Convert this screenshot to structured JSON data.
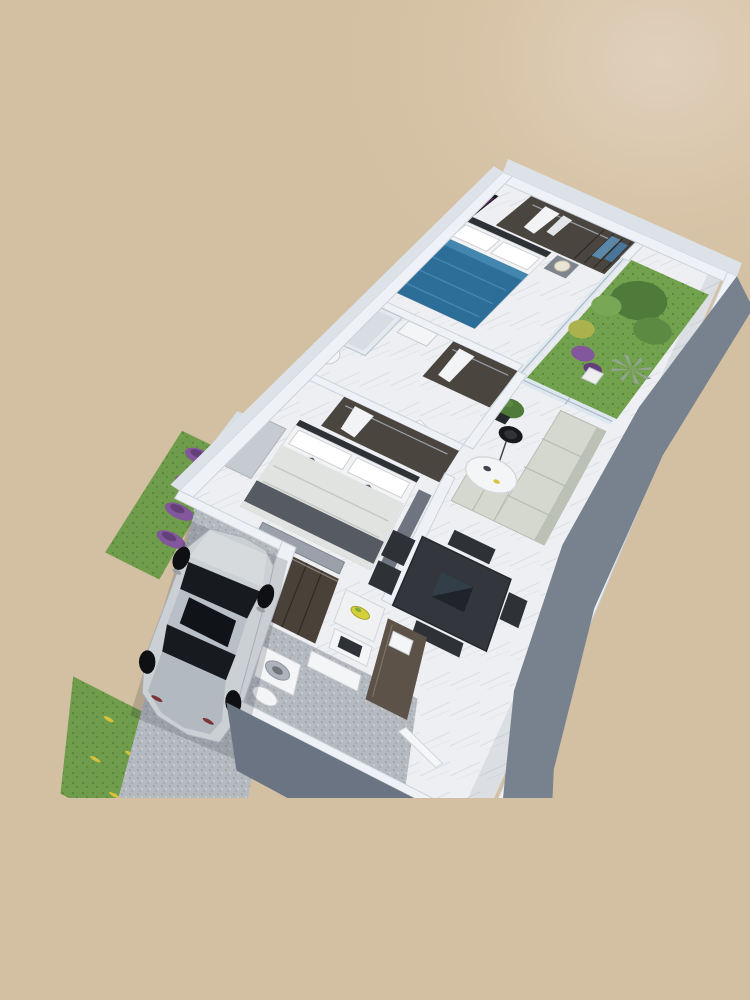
{
  "image": {
    "kind": "3d-floor-plan-render",
    "view": "isometric dollhouse top view, strip rotated toward lower-left, photo cropped flat at bottom",
    "background_color": "#d3bfa1",
    "background_highlight": "#e0d0bc",
    "crop_bottom_y": 798
  },
  "palette": {
    "bg": "#d3bfa1",
    "wall_cap": "#eef1f5",
    "wall_cap_stroke": "#ccd2da",
    "wall_face_dark": "#78828f",
    "wall_face_darker": "#6a7482",
    "wall_face_light": "#dde2e9",
    "floor_marble": "#edeff2",
    "floor_vein": "#c9cdd4",
    "room_shadow": "rgba(70,80,100,0.10)",
    "gravel": "#b5b9c0",
    "gravel_dot_dark": "#989da6",
    "gravel_dot_light": "#d9dce0",
    "grass": "#6f9d4c",
    "grass_dark": "#58853a",
    "garden_grass": "#73a24f",
    "foliage_dark": "#4f7a3a",
    "foliage_mid": "#5d8a43",
    "foliage_light": "#78a855",
    "foliage_yellow": "#aab24e",
    "palm_gray": "#95a396",
    "flower_purple": "#83579b",
    "flower_purple_dark": "#64407a",
    "flower_yellow": "#d8c23a",
    "wood_dark": "#4b4540",
    "wood_mid": "#5c5247",
    "kitchen_wood": "#4a4139",
    "furniture_dark": "#2e3237",
    "table_dark": "#33363c",
    "table_inset": "#20232a",
    "table_sheen": "#3a4a55",
    "bed_blue": "#2d6e98",
    "bed_blue_light": "#4487ae",
    "linen_white": "#f2f3f4",
    "pillow_gray": "#555a62",
    "duvet_gray": "#e0e3e0",
    "runner_gray": "#565b63",
    "bench_gray": "#9aa1aa",
    "sofa": "#d4d8ce",
    "sofa_shadow": "#bcc1b6",
    "lamp_black": "#17191c",
    "lamp_inner": "#303338",
    "lamp_shade_cream": "#eae4d4",
    "glass": "#d6e4ee",
    "tv_black": "#15171b",
    "tv_purple": "#5c2456",
    "tv_magenta": "#a8559c",
    "white_goods": "#f4f5f6",
    "island_white": "#f0f1f2",
    "dresser_light": "#c6cbd2",
    "nightstand_gray": "#7e858f",
    "wardrobe_gray": "#6e7581",
    "car_body": "#cbd0d5",
    "car_body_dark": "#b3b9c0",
    "car_glass": "#171a1f",
    "car_roof": "#b9bfc6",
    "car_wheel": "#0e1013",
    "car_taillight": "#7a3636",
    "walkway": "#e6e8ea",
    "fruit_yellow": "#d5cf3c",
    "fruit_green": "#7fae3f"
  },
  "rooms": [
    {
      "name": "master-bedroom",
      "furniture": [
        "walk-in-closet",
        "hanging-clothes",
        "blue-patterned-bed",
        "white-pillows",
        "wall-tv-unit",
        "nightstand",
        "table-lamp",
        "dresser"
      ]
    },
    {
      "name": "garden-patio",
      "features": [
        "grass",
        "large-shrubs",
        "yellow-bush",
        "purple-flowers",
        "gray-palm",
        "glass-partition",
        "white-chair"
      ]
    },
    {
      "name": "bathroom",
      "furniture": [
        "glass-shower",
        "sink-vanity",
        "toilet"
      ]
    },
    {
      "name": "hallway",
      "furniture": [
        "wardrobe",
        "hanging-shirt",
        "open-door"
      ]
    },
    {
      "name": "second-bedroom",
      "furniture": [
        "closet",
        "bed-gray-white",
        "accent-pillows",
        "foot-runner",
        "bench-ottoman",
        "purple-tv-art",
        "white-dresser",
        "wardrobe-panel",
        "window"
      ]
    },
    {
      "name": "living-room",
      "furniture": [
        "l-shaped-sofa",
        "black-floor-lamp",
        "round-coffee-table",
        "potted-ficus",
        "sliding-glass-door"
      ]
    },
    {
      "name": "dining-area",
      "furniture": [
        "square-dark-table",
        "center-inset",
        "dark-chairs"
      ]
    },
    {
      "name": "kitchen",
      "furniture": [
        "tall-dark-cabinets",
        "white-island",
        "fruit-bowl",
        "cooktop-unit",
        "long-wood-counter",
        "inset-sink"
      ]
    },
    {
      "name": "service-yard",
      "furniture": [
        "gravel-floor",
        "washing-machine",
        "utility-sink",
        "toilet",
        "open-door"
      ]
    },
    {
      "name": "driveway",
      "features": [
        "gravel",
        "white-hatchback-car",
        "paver-walkway",
        "grass-strip",
        "purple-flower-bushes",
        "lawn-with-yellow-flowers"
      ]
    }
  ]
}
